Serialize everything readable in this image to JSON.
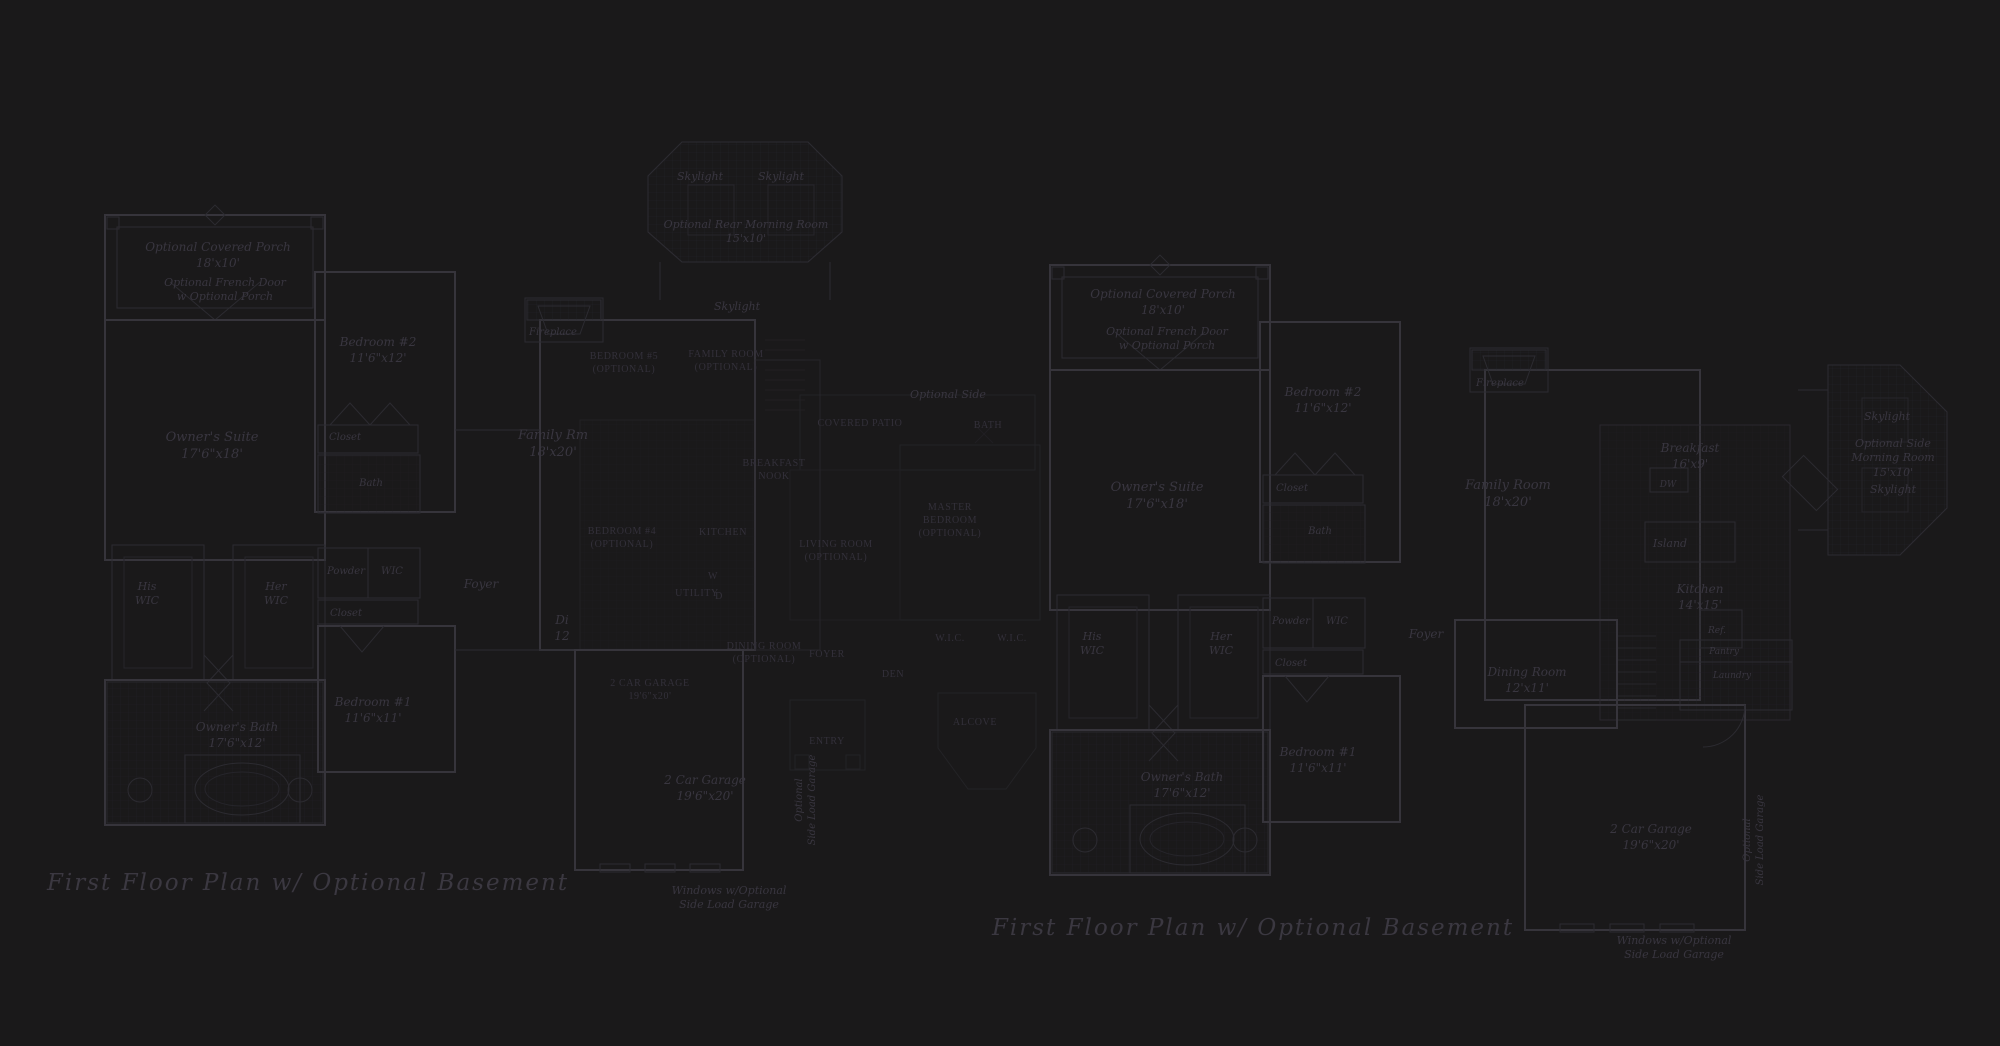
{
  "page": {
    "background_color": "#1a191a",
    "line_color": "#35343b",
    "text_color": "#393640",
    "caps_text_color": "#33303a"
  },
  "plans": {
    "left": {
      "title": "First Floor Plan  w/ Optional Basement",
      "labels": [
        {
          "name": "optional-covered-porch",
          "lines": [
            "Optional Covered Porch",
            "18'x10'"
          ],
          "x": 218,
          "y": 240,
          "size": 12
        },
        {
          "name": "optional-french-door",
          "lines": [
            "Optional French Door",
            "w Optional Porch"
          ],
          "x": 225,
          "y": 276,
          "size": 11
        },
        {
          "name": "owners-suite",
          "lines": [
            "Owner's Suite",
            "17'6\"x18'"
          ],
          "x": 212,
          "y": 430,
          "size": 13
        },
        {
          "name": "bedroom-2",
          "lines": [
            "Bedroom #2",
            "11'6\"x12'"
          ],
          "x": 378,
          "y": 335,
          "size": 12
        },
        {
          "name": "closet",
          "lines": [
            "Closet"
          ],
          "x": 345,
          "y": 431,
          "size": 10
        },
        {
          "name": "bath",
          "lines": [
            "Bath"
          ],
          "x": 371,
          "y": 477,
          "size": 10
        },
        {
          "name": "his-wic",
          "lines": [
            "His",
            "WIC"
          ],
          "x": 147,
          "y": 580,
          "size": 11
        },
        {
          "name": "her-wic",
          "lines": [
            "Her",
            "WIC"
          ],
          "x": 276,
          "y": 580,
          "size": 11
        },
        {
          "name": "powder",
          "lines": [
            "Powder"
          ],
          "x": 346,
          "y": 565,
          "size": 10
        },
        {
          "name": "wic",
          "lines": [
            "WIC"
          ],
          "x": 392,
          "y": 565,
          "size": 10
        },
        {
          "name": "closet-2",
          "lines": [
            "Closet"
          ],
          "x": 346,
          "y": 607,
          "size": 10
        },
        {
          "name": "bedroom-1",
          "lines": [
            "Bedroom #1",
            "11'6\"x11'"
          ],
          "x": 373,
          "y": 695,
          "size": 12
        },
        {
          "name": "owners-bath",
          "lines": [
            "Owner's Bath",
            "17'6\"x12'"
          ],
          "x": 237,
          "y": 720,
          "size": 12
        },
        {
          "name": "fireplace",
          "lines": [
            "Fireplace"
          ],
          "x": 553,
          "y": 326,
          "size": 10
        },
        {
          "name": "family-rm",
          "lines": [
            "Family Rm",
            "18'x20'"
          ],
          "x": 553,
          "y": 428,
          "size": 13
        },
        {
          "name": "foyer",
          "lines": [
            "Foyer"
          ],
          "x": 481,
          "y": 577,
          "size": 12
        },
        {
          "name": "dining-partial",
          "lines": [
            "Di",
            "12"
          ],
          "x": 562,
          "y": 613,
          "size": 12
        },
        {
          "name": "car-garage",
          "lines": [
            "2 Car Garage",
            "19'6\"x20'"
          ],
          "x": 705,
          "y": 773,
          "size": 12
        },
        {
          "name": "windows-note",
          "lines": [
            "Windows w/Optional",
            "Side Load Garage"
          ],
          "x": 729,
          "y": 884,
          "size": 11
        },
        {
          "name": "side-load-garage-vertical",
          "lines": [
            "Optional",
            "Side Load Garage"
          ],
          "x": 806,
          "y": 800,
          "size": 10,
          "rotate": -90
        },
        {
          "name": "skylight-1",
          "lines": [
            "Skylight"
          ],
          "x": 700,
          "y": 170,
          "size": 11
        },
        {
          "name": "skylight-2",
          "lines": [
            "Skylight"
          ],
          "x": 781,
          "y": 170,
          "size": 11
        },
        {
          "name": "optional-rear-morning-room",
          "lines": [
            "Optional Rear Morning Room",
            "15'x10'"
          ],
          "x": 746,
          "y": 218,
          "size": 11
        },
        {
          "name": "skylight-3",
          "lines": [
            "Skylight"
          ],
          "x": 737,
          "y": 300,
          "size": 11
        },
        {
          "name": "optional-side",
          "lines": [
            "Optional Side"
          ],
          "x": 948,
          "y": 388,
          "size": 11
        },
        {
          "name": "bedroom-5-optional",
          "lines": [
            "BEDROOM #5",
            "(OPTIONAL)"
          ],
          "caps": true,
          "x": 624,
          "y": 350
        },
        {
          "name": "family-room-optional",
          "lines": [
            "FAMILY ROOM",
            "(OPTIONAL)"
          ],
          "caps": true,
          "x": 726,
          "y": 348
        },
        {
          "name": "breakfast-nook",
          "lines": [
            "BREAKFAST",
            "NOOK"
          ],
          "caps": true,
          "x": 774,
          "y": 457
        },
        {
          "name": "bedroom-4-optional",
          "lines": [
            "BEDROOM #4",
            "(OPTIONAL)"
          ],
          "caps": true,
          "x": 622,
          "y": 525
        },
        {
          "name": "kitchen-caps",
          "lines": [
            "KITCHEN"
          ],
          "caps": true,
          "x": 723,
          "y": 526
        },
        {
          "name": "utility",
          "lines": [
            "UTILITY"
          ],
          "caps": true,
          "x": 697,
          "y": 587
        },
        {
          "name": "washer",
          "lines": [
            "W"
          ],
          "caps": true,
          "x": 713,
          "y": 570
        },
        {
          "name": "dryer",
          "lines": [
            "D"
          ],
          "caps": true,
          "x": 719,
          "y": 590
        },
        {
          "name": "two-car-garage-caps",
          "lines": [
            "2 CAR GARAGE",
            "19'6\"x20'"
          ],
          "caps": true,
          "x": 650,
          "y": 677
        },
        {
          "name": "dining-room-caps",
          "lines": [
            "DINING ROOM",
            "(OPTIONAL)"
          ],
          "caps": true,
          "x": 764,
          "y": 640
        },
        {
          "name": "foyer-caps",
          "lines": [
            "FOYER"
          ],
          "caps": true,
          "x": 827,
          "y": 648
        },
        {
          "name": "den-caps",
          "lines": [
            "DEN"
          ],
          "caps": true,
          "x": 893,
          "y": 668
        },
        {
          "name": "entry-caps",
          "lines": [
            "ENTRY"
          ],
          "caps": true,
          "x": 827,
          "y": 735
        },
        {
          "name": "covered-patio",
          "lines": [
            "COVERED PATIO"
          ],
          "caps": true,
          "x": 860,
          "y": 417
        },
        {
          "name": "bath-caps",
          "lines": [
            "BATH"
          ],
          "caps": true,
          "x": 988,
          "y": 419
        },
        {
          "name": "master-bedroom",
          "lines": [
            "MASTER",
            "BEDROOM",
            "(OPTIONAL)"
          ],
          "caps": true,
          "x": 950,
          "y": 501
        },
        {
          "name": "living-room",
          "lines": [
            "LIVING ROOM",
            "(OPTIONAL)"
          ],
          "caps": true,
          "x": 836,
          "y": 538
        },
        {
          "name": "wic-caps-1",
          "lines": [
            "W.I.C."
          ],
          "caps": true,
          "x": 950,
          "y": 632
        },
        {
          "name": "wic-caps-2",
          "lines": [
            "W.I.C."
          ],
          "caps": true,
          "x": 1012,
          "y": 632
        },
        {
          "name": "alcove",
          "lines": [
            "ALCOVE"
          ],
          "caps": true,
          "x": 975,
          "y": 716
        }
      ]
    },
    "right": {
      "title": "First Floor Plan  w/ Optional Basement",
      "labels": [
        {
          "name": "optional-covered-porch",
          "lines": [
            "Optional Covered Porch",
            "18'x10'"
          ],
          "x": 1163,
          "y": 287,
          "size": 12
        },
        {
          "name": "optional-french-door",
          "lines": [
            "Optional French Door",
            "w Optional Porch"
          ],
          "x": 1167,
          "y": 325,
          "size": 11
        },
        {
          "name": "bedroom-2",
          "lines": [
            "Bedroom #2",
            "11'6\"x12'"
          ],
          "x": 1323,
          "y": 385,
          "size": 12
        },
        {
          "name": "owners-suite",
          "lines": [
            "Owner's Suite",
            "17'6\"x18'"
          ],
          "x": 1157,
          "y": 480,
          "size": 13
        },
        {
          "name": "closet",
          "lines": [
            "Closet"
          ],
          "x": 1292,
          "y": 482,
          "size": 10
        },
        {
          "name": "bath",
          "lines": [
            "Bath"
          ],
          "x": 1320,
          "y": 525,
          "size": 10
        },
        {
          "name": "family-room",
          "lines": [
            "Family Room",
            "18'x20'"
          ],
          "x": 1508,
          "y": 478,
          "size": 13
        },
        {
          "name": "fireplace",
          "lines": [
            "Fireplace"
          ],
          "x": 1500,
          "y": 377,
          "size": 10
        },
        {
          "name": "breakfast",
          "lines": [
            "Breakfast",
            "16'x9'"
          ],
          "x": 1690,
          "y": 441,
          "size": 12
        },
        {
          "name": "dw",
          "lines": [
            "DW"
          ],
          "x": 1668,
          "y": 480,
          "size": 9
        },
        {
          "name": "island",
          "lines": [
            "Island"
          ],
          "x": 1670,
          "y": 537,
          "size": 11
        },
        {
          "name": "kitchen",
          "lines": [
            "Kitchen",
            "14'x15'"
          ],
          "x": 1700,
          "y": 582,
          "size": 12
        },
        {
          "name": "ref",
          "lines": [
            "Ref."
          ],
          "x": 1717,
          "y": 626,
          "size": 9
        },
        {
          "name": "skylight-1",
          "lines": [
            "Skylight"
          ],
          "x": 1887,
          "y": 410,
          "size": 11
        },
        {
          "name": "optional-side-morning-room",
          "lines": [
            "Optional Side",
            "Morning Room",
            "15'x10'"
          ],
          "x": 1893,
          "y": 437,
          "size": 11
        },
        {
          "name": "skylight-2",
          "lines": [
            "Skylight"
          ],
          "x": 1893,
          "y": 483,
          "size": 11
        },
        {
          "name": "his-wic",
          "lines": [
            "His",
            "WIC"
          ],
          "x": 1092,
          "y": 630,
          "size": 11
        },
        {
          "name": "her-wic",
          "lines": [
            "Her",
            "WIC"
          ],
          "x": 1221,
          "y": 630,
          "size": 11
        },
        {
          "name": "powder",
          "lines": [
            "Powder"
          ],
          "x": 1291,
          "y": 615,
          "size": 10
        },
        {
          "name": "wic",
          "lines": [
            "WIC"
          ],
          "x": 1337,
          "y": 615,
          "size": 10
        },
        {
          "name": "closet-2",
          "lines": [
            "Closet"
          ],
          "x": 1291,
          "y": 657,
          "size": 10
        },
        {
          "name": "bedroom-1",
          "lines": [
            "Bedroom #1",
            "11'6\"x11'"
          ],
          "x": 1318,
          "y": 745,
          "size": 12
        },
        {
          "name": "owners-bath",
          "lines": [
            "Owner's Bath",
            "17'6\"x12'"
          ],
          "x": 1182,
          "y": 770,
          "size": 12
        },
        {
          "name": "dining-room",
          "lines": [
            "Dining Room",
            "12'x11'"
          ],
          "x": 1527,
          "y": 665,
          "size": 12
        },
        {
          "name": "foyer",
          "lines": [
            "Foyer"
          ],
          "x": 1426,
          "y": 627,
          "size": 12
        },
        {
          "name": "pantry",
          "lines": [
            "Pantry"
          ],
          "x": 1724,
          "y": 647,
          "size": 9
        },
        {
          "name": "laundry",
          "lines": [
            "Laundry"
          ],
          "x": 1732,
          "y": 671,
          "size": 9
        },
        {
          "name": "car-garage",
          "lines": [
            "2 Car Garage",
            "19'6\"x20'"
          ],
          "x": 1651,
          "y": 822,
          "size": 12
        },
        {
          "name": "side-load-garage-vertical",
          "lines": [
            "Optional",
            "Side Load Garage"
          ],
          "x": 1754,
          "y": 840,
          "size": 10,
          "rotate": -90
        },
        {
          "name": "windows-note",
          "lines": [
            "Windows w/Optional",
            "Side Load Garage"
          ],
          "x": 1674,
          "y": 934,
          "size": 11
        }
      ]
    }
  }
}
